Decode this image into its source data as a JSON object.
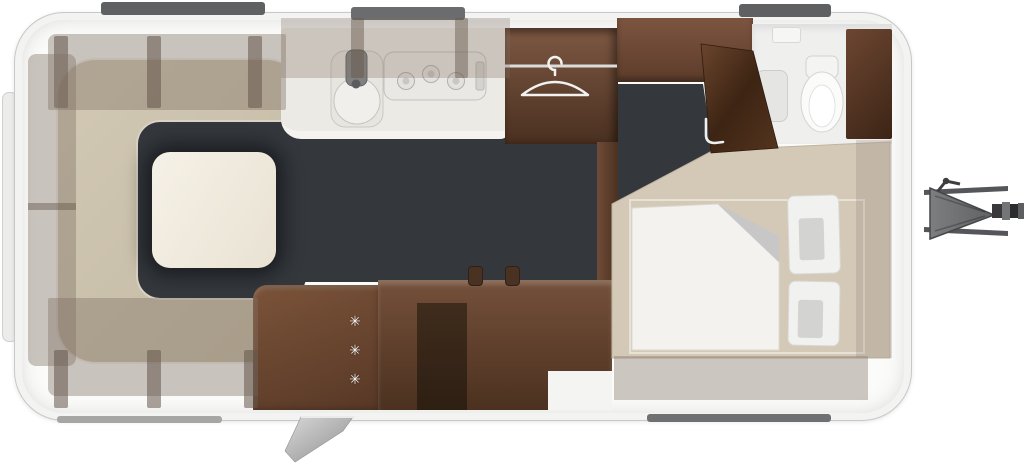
{
  "scene": {
    "type": "caravan-floor-plan",
    "view": "top-down",
    "hitch_side": "right"
  },
  "palette": {
    "shell": "#fbfbfa",
    "wall_outline": "#c8c8c8",
    "wood_light": "#7b5339",
    "wood_dark": "#4c3120",
    "floor_dark": "#34383d",
    "upholstery": "#cbc1ac",
    "bed_base": "#d3c9b6",
    "linen_white": "#f3f2ef",
    "locker_overlay": "rgba(128,112,99,0.40)",
    "window_gray": "#5e6062",
    "hitch_gray": "#707274"
  },
  "kitchen": {
    "burner_count": 3
  },
  "bedroom": {
    "pillow_count": 2
  },
  "fridge": {
    "snowflake_glyph": "✳",
    "snowflake_count": 3
  }
}
